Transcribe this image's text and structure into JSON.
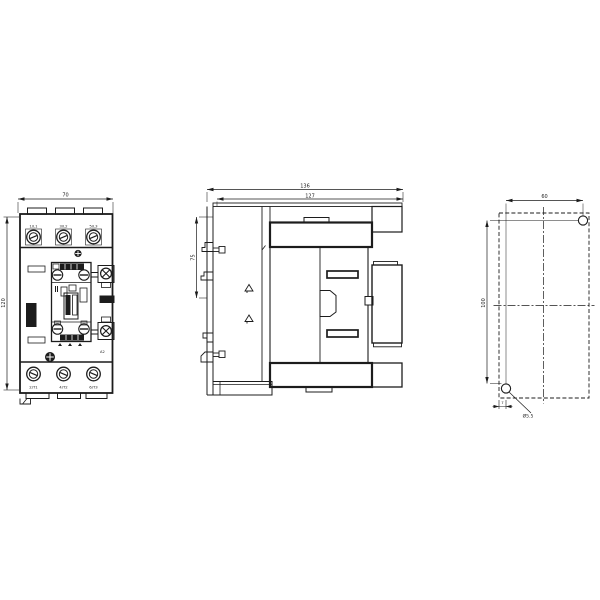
{
  "meta": {
    "drawing_type": "technical dimension drawing",
    "subject": "3-pole contactor, three orthographic views"
  },
  "front_view": {
    "width_mm": "70",
    "height_mm": "120",
    "top_terminals": [
      "1/L1",
      "3/L2",
      "5/L3"
    ],
    "bottom_terminals": [
      "2/T1",
      "4/T2",
      "6/T3"
    ],
    "coil_terminal_top": "A1",
    "coil_terminal_bottom": "A2"
  },
  "side_view": {
    "overall_depth_mm": "136",
    "inner_depth_mm": "127",
    "rail_height_mm": "75"
  },
  "mounting_view": {
    "hole_spacing_width_mm": "60",
    "hole_spacing_height_mm": "100",
    "hole_offset_mm": "7",
    "hole_diameter_note": "Ø5.5"
  }
}
